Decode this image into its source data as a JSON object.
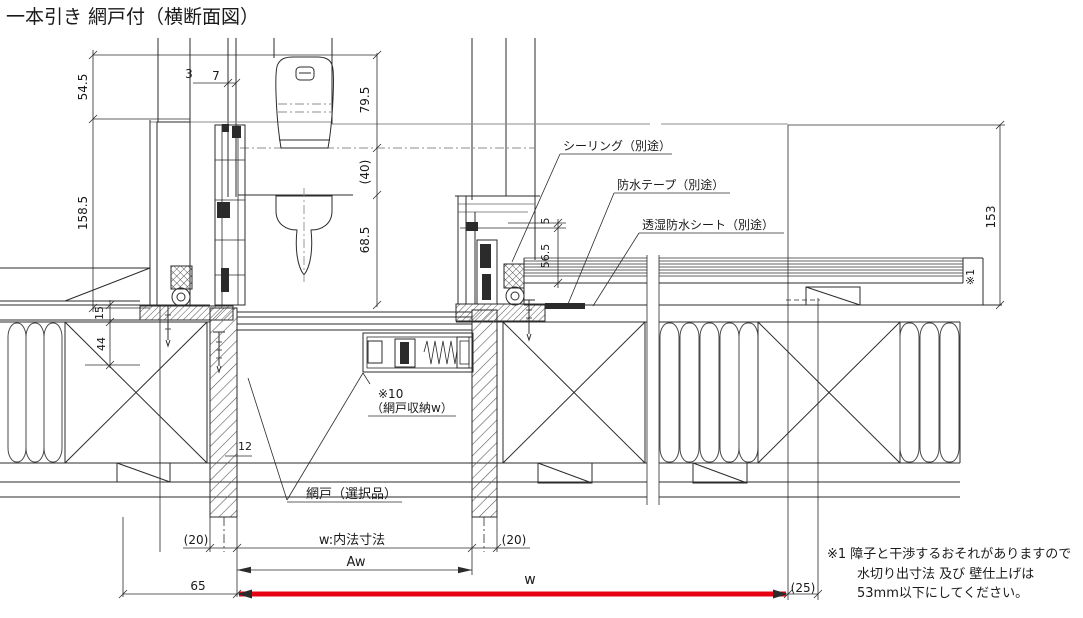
{
  "title": "一本引き 網戸付（横断面図）",
  "callouts": {
    "sealing": "シーリング（別途）",
    "tape": "防水テープ（別途）",
    "sheet": "透湿防水シート（別途）",
    "screen_storage_l1": "※10",
    "screen_storage_l2": "（網戸収納w）",
    "screen_door": "網戸（選択品）",
    "ref_mark": "※1"
  },
  "dims": {
    "d54_5": "54.5",
    "d158_5": "158.5",
    "d3": "3",
    "d7": "7",
    "d79_5": "79.5",
    "d40": "(40)",
    "d68_5": "68.5",
    "d5": "5",
    "d56_5": "56.5",
    "d153": "153",
    "d15": "15",
    "d44": "44",
    "d12": "12",
    "d20_left": "(20)",
    "d20_right": "(20)",
    "d65": "65",
    "d25": "(25)",
    "aw": "Aw",
    "w": "w",
    "w_inner": "w:内法寸法"
  },
  "note": {
    "l1": "※1 障子と干渉するおそれがありますので",
    "l2": "水切り出寸法 及び 壁仕上げは",
    "l3": "53mm以下にしてください。"
  },
  "colors": {
    "line": "#2b2b2b",
    "accent_red": "#e60012",
    "background": "#ffffff"
  }
}
